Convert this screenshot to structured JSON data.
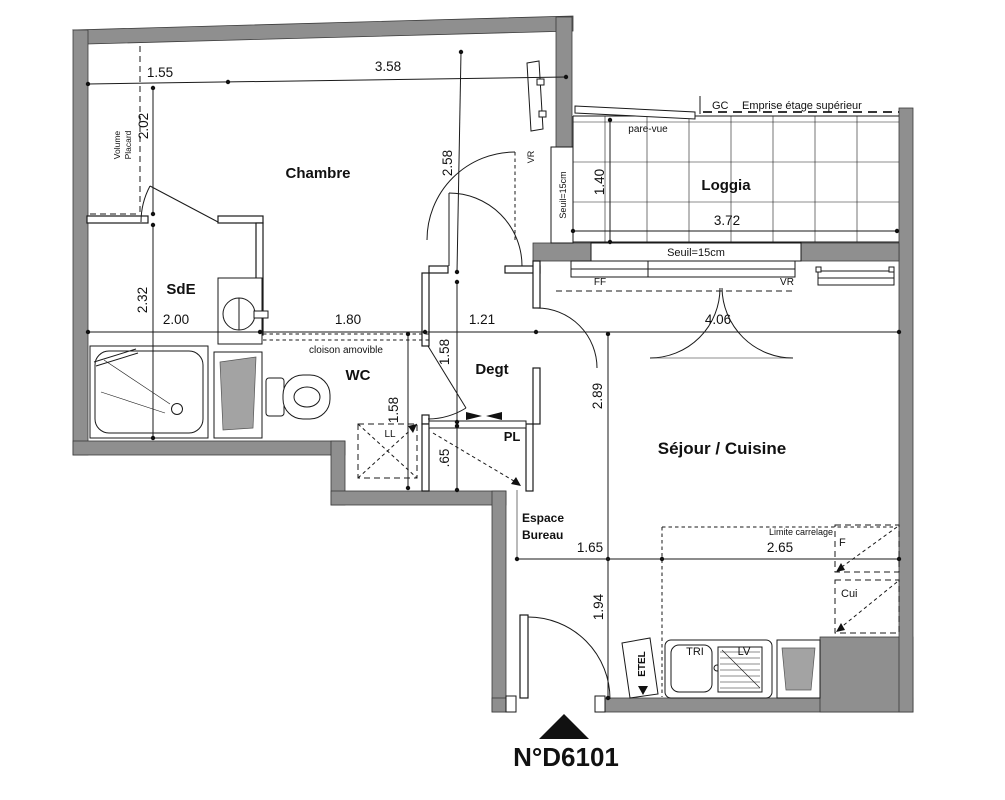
{
  "plan_title": "N°D6101",
  "rooms": {
    "chambre": "Chambre",
    "loggia": "Loggia",
    "sde": "SdE",
    "wc": "WC",
    "degt": "Degt",
    "sejour": "Séjour / Cuisine",
    "pl": "PL",
    "ll": "LL",
    "espace_line1": "Espace",
    "espace_line2": "Bureau",
    "cui": "Cui",
    "frigo": "F"
  },
  "annotations": {
    "gc": "GC",
    "emprise": "Emprise étage supérieur",
    "pare_vue": "pare-vue",
    "seuil_loggia_door": "Seuil=15cm",
    "seuil_loggia_edge": "Seuil=15cm",
    "cloison": "cloison amovible",
    "limite_carrelage": "Limite carrelage",
    "vr_chambre": "VR",
    "ff": "FF",
    "vr_sejour": "VR",
    "volume_line1": "Volume",
    "volume_line2": "Placard",
    "etel": "ETEL",
    "tri": "TRI",
    "lv": "LV"
  },
  "dimensions": {
    "d155": "1.55",
    "d358": "3.58",
    "d202": "2.02",
    "d258": "2.58",
    "d140": "1.40",
    "d372": "3.72",
    "d232": "2.32",
    "d200": "2.00",
    "d180": "1.80",
    "d121": "1.21",
    "d406": "4.06",
    "d158_wc": "1.58",
    "d158_degt": "1.58",
    "d065": ".65",
    "d289": "2.89",
    "d165": "1.65",
    "d265": "2.65",
    "d194": "1.94"
  },
  "colors": {
    "wall": "#8f8f8f",
    "line": "#1a1a1a",
    "background": "#ffffff"
  }
}
